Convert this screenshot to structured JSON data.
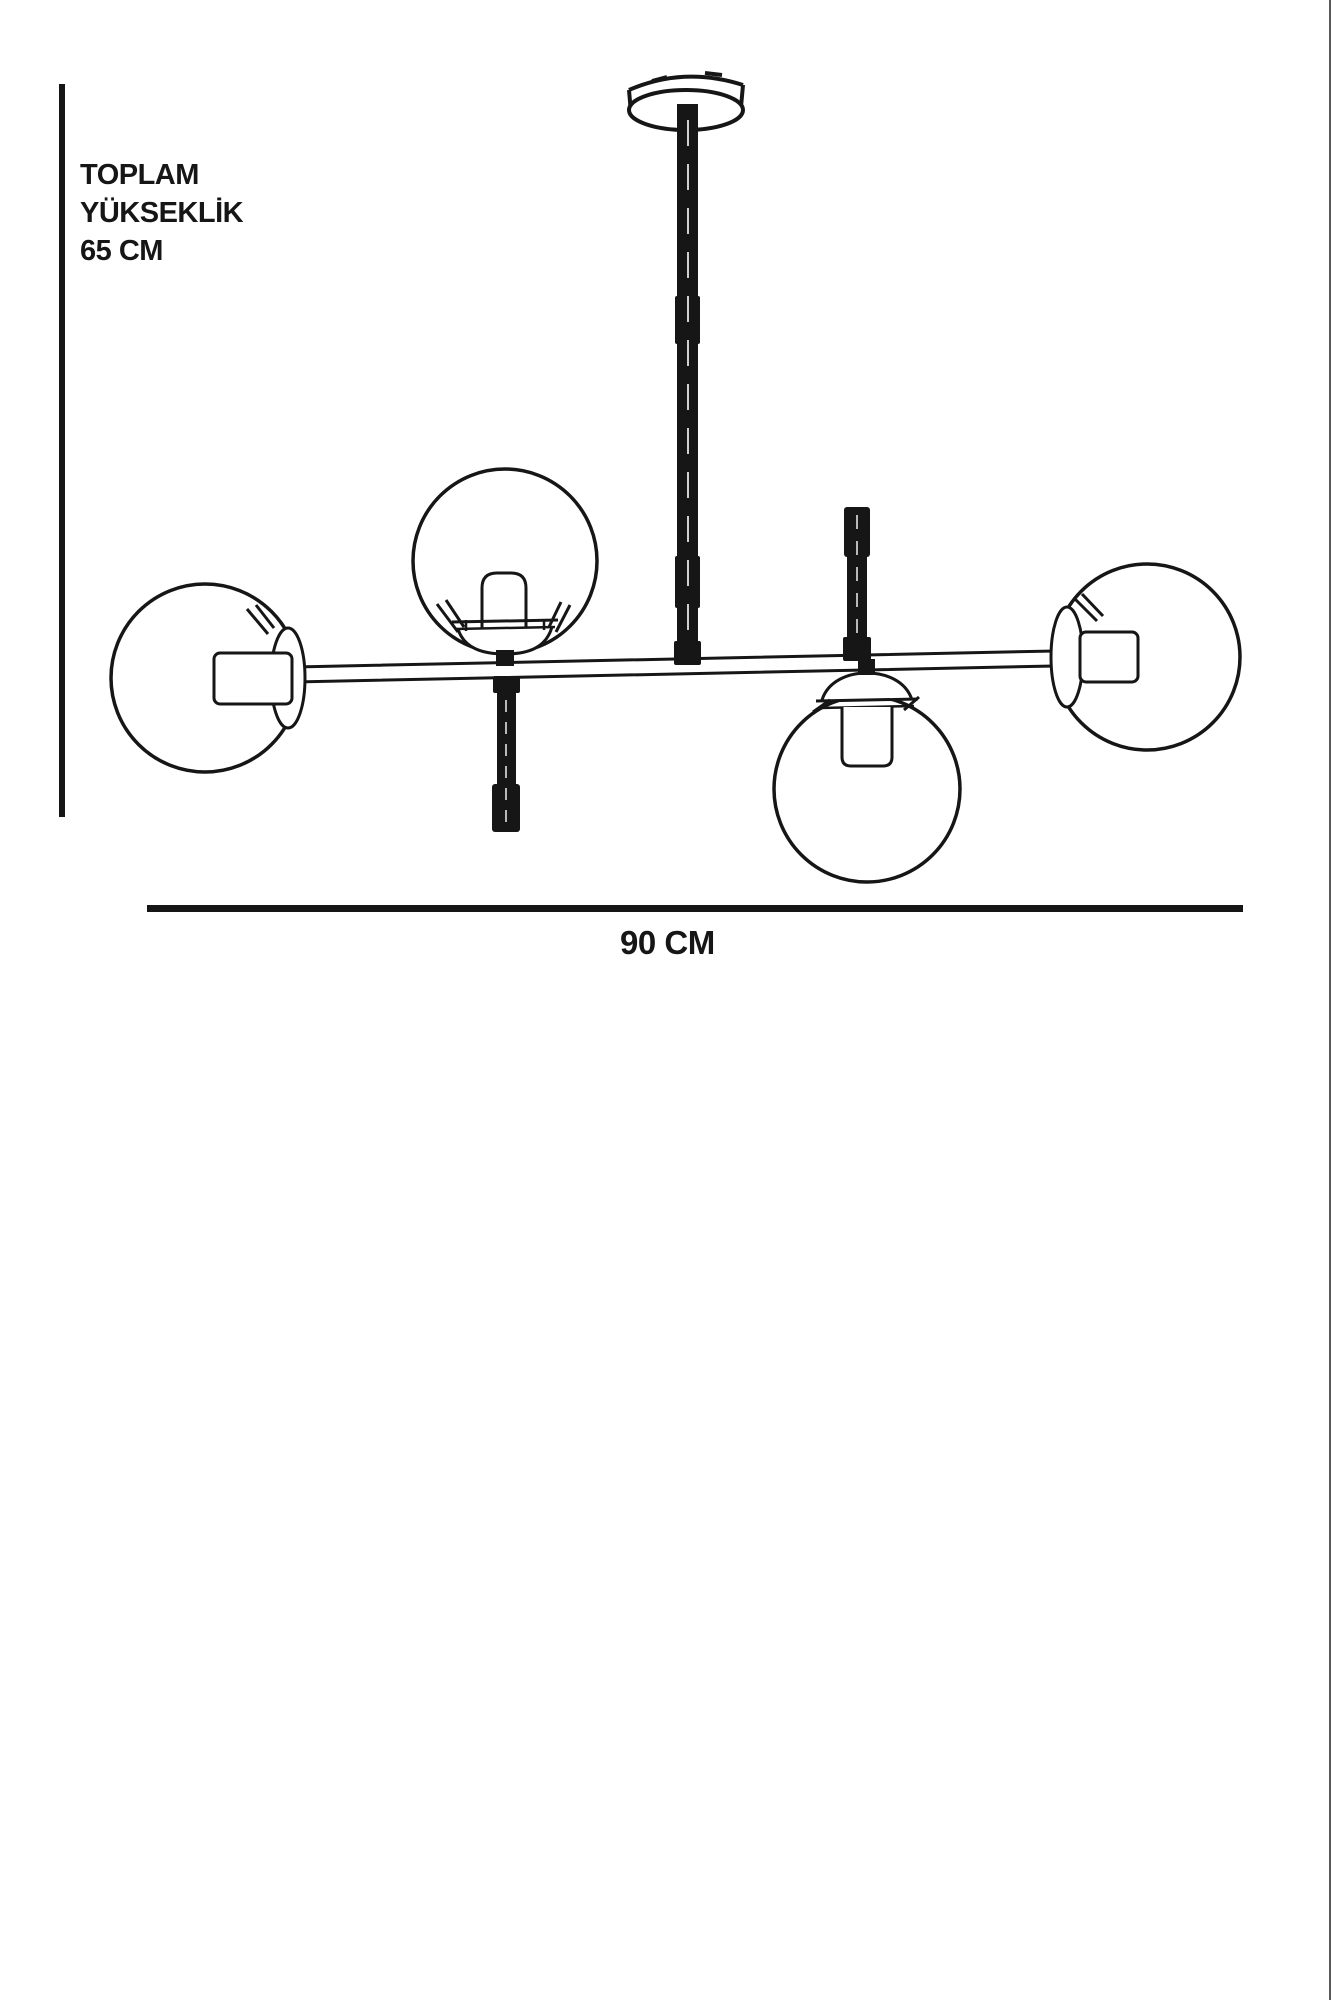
{
  "labels": {
    "total_height": {
      "line1": "TOPLAM",
      "line2": "YÜKSEKLİK",
      "line3": "65 CM"
    },
    "width": "90 CM"
  },
  "colors": {
    "ink": "#161616",
    "background": "#ffffff"
  }
}
